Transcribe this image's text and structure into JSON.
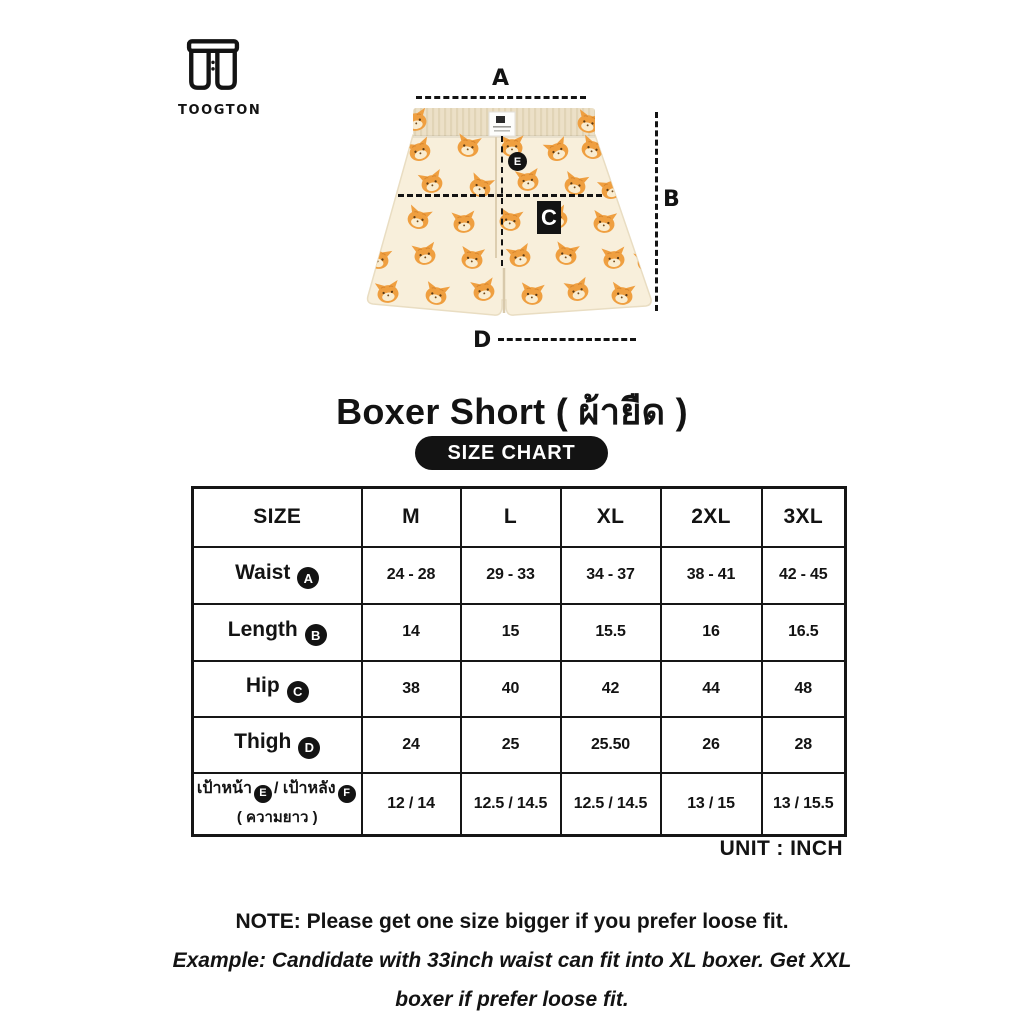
{
  "brand": {
    "name": "TOOGTON"
  },
  "product": {
    "title": "Boxer Short ( ผ้ายืด )"
  },
  "diagram": {
    "labels": {
      "a": "A",
      "b": "B",
      "c": "C",
      "d": "D",
      "e": "E"
    }
  },
  "size_chart": {
    "badge_label": "SIZE CHART",
    "unit_label": "UNIT : INCH",
    "columns": [
      "SIZE",
      "M",
      "L",
      "XL",
      "2XL",
      "3XL"
    ],
    "rows": [
      {
        "label": "Waist",
        "badge": "A",
        "values": [
          "24 - 28",
          "29 - 33",
          "34 - 37",
          "38 - 41",
          "42 - 45"
        ]
      },
      {
        "label": "Length",
        "badge": "B",
        "values": [
          "14",
          "15",
          "15.5",
          "16",
          "16.5"
        ]
      },
      {
        "label": "Hip",
        "badge": "C",
        "values": [
          "38",
          "40",
          "42",
          "44",
          "48"
        ]
      },
      {
        "label": "Thigh",
        "badge": "D",
        "values": [
          "24",
          "25",
          "25.50",
          "26",
          "28"
        ]
      },
      {
        "label_front": "เป้าหน้า",
        "badge_front": "E",
        "label_mid": "/ เป้าหลัง",
        "badge_back": "F",
        "label_sub": "( ความยาว )",
        "values": [
          "12 / 14",
          "12.5 / 14.5",
          "12.5 / 14.5",
          "13 / 15",
          "13 / 15.5"
        ]
      }
    ]
  },
  "note": {
    "line1": "NOTE: Please get one size bigger if you prefer loose fit.",
    "line2": "Example: Candidate with 33inch waist can fit into XL boxer. Get XXL",
    "line3": "boxer if prefer loose fit."
  },
  "colors": {
    "ink": "#131313",
    "fabric": "#f8efdb",
    "waistband": "#ece0c7",
    "cat_orange": "#ef9f40"
  }
}
